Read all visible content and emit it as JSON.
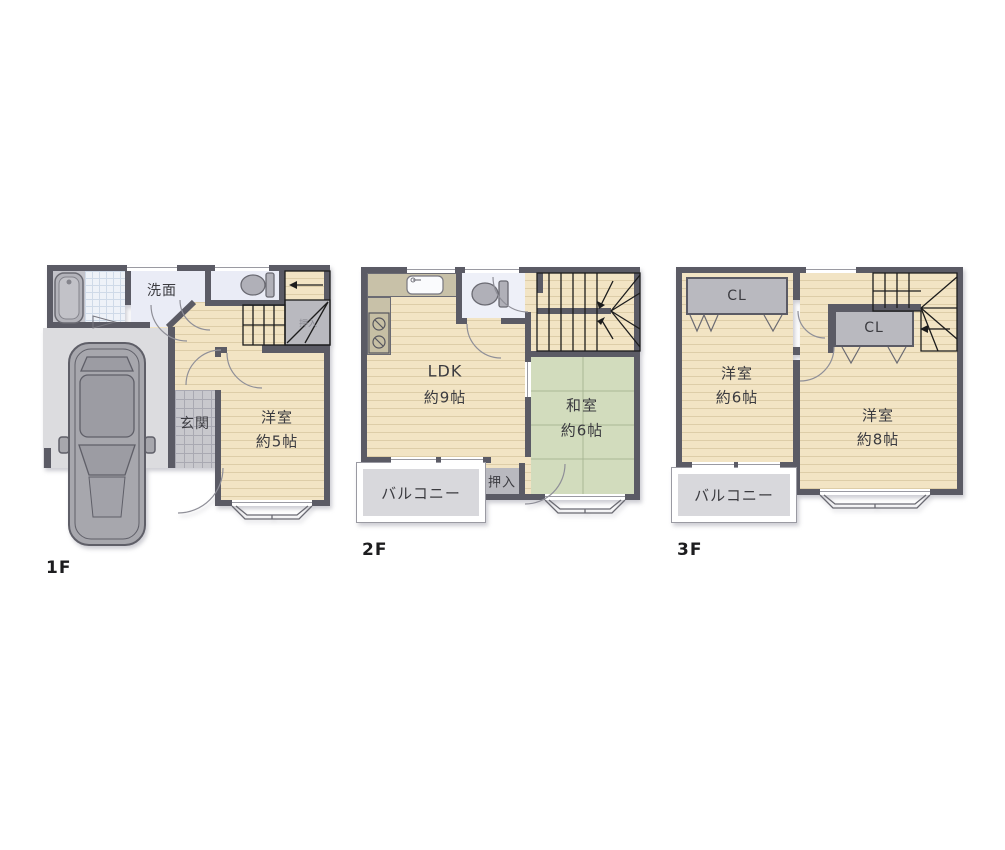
{
  "colors": {
    "wall": "#5b5b65",
    "wood_floor": "#f2e4c4",
    "wood_stripe": "#ddcda8",
    "tatami": "#d2dcbd",
    "tatami_line": "#a9b795",
    "closet_gray": "#b9b9bf",
    "balcony_floor": "#d8d8dc",
    "entrance_tile": "#c8c8cd",
    "garage_floor": "#dcdcdf",
    "bath_tile": "#eef2f8",
    "lavender_floor": "#eaecf6",
    "kitchen_counter": "#c8c1a8",
    "car_body": "#a7a7ad",
    "text": "#3b3b40"
  },
  "floors": [
    {
      "label": "1F",
      "rooms": {
        "washroom": "洗面",
        "entrance": "玄関",
        "bedroom": "洋室",
        "bedroom_size": "約5帖",
        "stair_closet": "押入"
      }
    },
    {
      "label": "2F",
      "rooms": {
        "ldk": "LDK",
        "ldk_size": "約9帖",
        "japanese_room": "和室",
        "japanese_room_size": "約6帖",
        "closet": "押入",
        "balcony": "バルコニー"
      }
    },
    {
      "label": "3F",
      "rooms": {
        "closet_left": "CL",
        "bedroom_left": "洋室",
        "bedroom_left_size": "約6帖",
        "closet_right": "CL",
        "bedroom_right": "洋室",
        "bedroom_right_size": "約8帖",
        "balcony": "バルコニー"
      }
    }
  ]
}
